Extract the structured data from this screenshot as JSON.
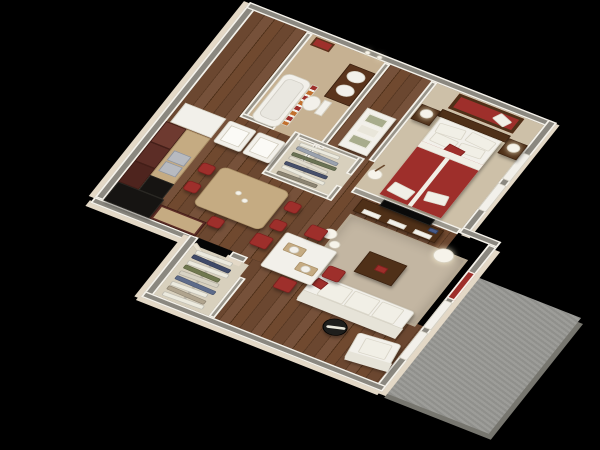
{
  "scene": {
    "description": "3D isometric cutaway render of a one-bedroom apartment floor plan, viewed from above at an angle, on a solid black background",
    "background_color": "#000000",
    "projection": "isometric bird's-eye",
    "visible_text": []
  },
  "palette": {
    "background": "#000000",
    "wall_top": "#8b8880",
    "wall_top_int": "#9a968c",
    "wall_edge": "#f5f2ea",
    "wall_face": "#e3d8c6",
    "wood_floor": "#6b4730",
    "carpet": "#cdc0a8",
    "bath_floor": "#c6b192",
    "rug": "#c3b6a2",
    "patio": "#989894",
    "cabinet": "#5c2d26",
    "counter": "#c5ab82",
    "appliance": "#161412",
    "accent_red": "#9e2f2b",
    "curtain_orange": "#c2702e",
    "upholstery": "#eceade",
    "walnut": "#4f3018",
    "white_goods": "#f2f0ea",
    "steel": "#b7bac0",
    "sage": "#a8ac8c"
  },
  "rooms": {
    "kitchen": {
      "label": "Kitchen",
      "items": [
        "L-shaped dark maroon-wood cabinets",
        "tan stone countertop",
        "double stainless sink",
        "black range",
        "black refrigerator",
        "tall tan bar table with two white cups",
        "five red bar stools"
      ]
    },
    "dining": {
      "label": "Dining area",
      "items": [
        "square white table",
        "four red metal-leg chairs",
        "two tan placemats with white plates"
      ]
    },
    "bathroom": {
      "label": "Bathroom",
      "items": [
        "white bathtub",
        "red-orange striped shower curtain",
        "white toilet",
        "dark wood double-sink vanity",
        "red framed wall art",
        "two wall sconces"
      ]
    },
    "laundry": {
      "label": "Laundry nook",
      "items": [
        "white top-load washer",
        "white top-load dryer",
        "white storage cabinet"
      ]
    },
    "walk_in_closet": {
      "label": "Walk-in closet",
      "garments": [
        "#eceade",
        "#9aa2ae",
        "#6b7355",
        "#e2ddcf",
        "#47506b",
        "#eceade",
        "#8d8573"
      ]
    },
    "entry": {
      "label": "Entry",
      "items": [
        "open front door",
        "coat closet"
      ],
      "closet_garments": [
        "#eceade",
        "#3f4a68",
        "#eceade",
        "#70784f",
        "#d8d3c4",
        "#5d6b8a",
        "#eceade",
        "#b0a48e",
        "#eceade"
      ]
    },
    "bedroom": {
      "label": "Bedroom",
      "items": [
        "queen bed with red duvet and white linens",
        "dark wood headboard",
        "two dark wood nightstands",
        "two white table lamps",
        "red-backed wall mirror art",
        "white dresser with three sage trays",
        "white vase with branches",
        "two windows"
      ]
    },
    "living": {
      "label": "Living room",
      "items": [
        "dark wood TV console with white drawers",
        "flat-screen TV on half wall",
        "beige area rug",
        "dark wood coffee table",
        "white three-seat sofa",
        "red throw pillow",
        "white armchair",
        "black-and-white drum side table",
        "white floor lamp",
        "white decorative vases",
        "patio door with red curtain",
        "two windows"
      ]
    },
    "patio": {
      "label": "Patio",
      "items": [
        "bare concrete slab"
      ]
    }
  }
}
